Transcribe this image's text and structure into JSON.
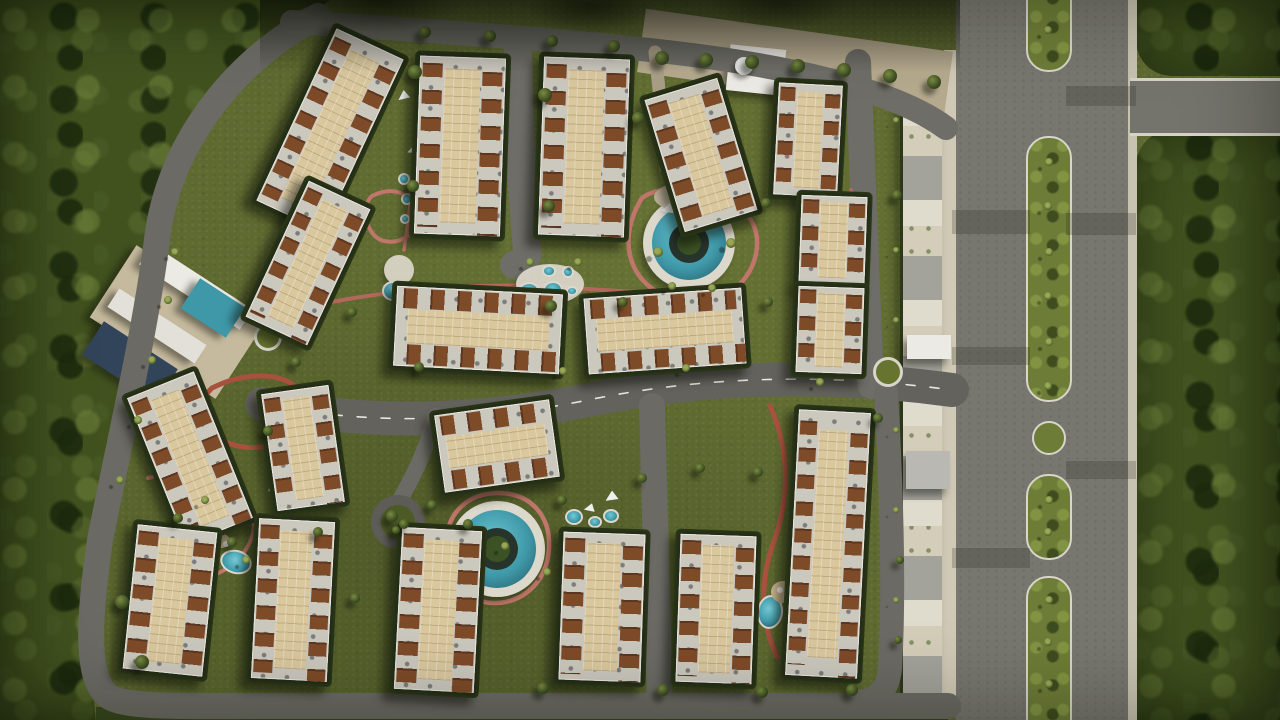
{
  "meta": {
    "title": "Aerial top-view 3D master-plan render of a gated residential compound with apartment blocks, pools, landscaped paths, a perimeter road and a tree-lined boulevard",
    "width": 1280,
    "height": 720
  },
  "palette": {
    "grass": "#5e6a30",
    "forest": "#42521f",
    "hedge": "#232c15",
    "asphalt": "#6b6a64",
    "asphalt2": "#6e6d67",
    "boulevard": "#77766f",
    "curb": "#d8d5ca",
    "roofslab": "#cbc8be",
    "court": "#d9c79e",
    "brown": "#7e4b29",
    "teal": "#3f98a8",
    "tealdeep": "#235663",
    "pink": "#c0766a",
    "redtrack": "#a8513e",
    "plaza": "#b5a98e",
    "deck": "#c6ba9e",
    "white": "#eceae4",
    "white2": "#e2e0d8",
    "gray": "#d8d7d0",
    "gray2": "#b9b8b2",
    "solar": "#31445a",
    "sand": "#c9b58f",
    "decklight": "#ddd8cc"
  },
  "scene": {
    "roads": [
      {
        "n": "perimeter-road",
        "d": "M 318,16 C 238,58 172,138 158,232 C 146,328 124,420 100,540 C 88,622 86,678 108,696 C 126,708 180,706 260,706 L 948,706",
        "w": 26,
        "c": "#6b6a64"
      },
      {
        "n": "top-road",
        "d": "M 292,22 C 420,30 540,38 650,50 C 780,64 892,88 946,128",
        "w": 24,
        "c": "#6e6d67"
      },
      {
        "n": "central-road",
        "d": "M 262,404 C 372,426 480,422 588,400 C 700,377 820,372 952,390",
        "w": 34,
        "c": "#63625c"
      },
      {
        "n": "central-road-dashes",
        "d": "M 262,404 C 372,426 480,422 588,400 C 700,377 820,372 952,390",
        "w": 1.6,
        "c": "#e8e6de",
        "dash": "9 15"
      },
      {
        "n": "road-v1",
        "d": "M 518,48 C 520,140 522,204 527,250 C 529,259 524,263 514,265",
        "w": 28,
        "c": "#6e6d67"
      },
      {
        "n": "road-v2",
        "d": "M 858,62 L 871,386",
        "w": 26,
        "c": "#6e6d67"
      },
      {
        "n": "road-v3",
        "d": "M 652,406 L 660,704",
        "w": 26,
        "c": "#6b6a64"
      },
      {
        "n": "road-v4",
        "d": "M 886,392 C 892,500 894,600 890,668 C 888,690 878,700 858,702",
        "w": 24,
        "c": "#6b6a64"
      },
      {
        "n": "road-spur",
        "d": "M 436,416 C 424,456 412,478 401,498",
        "w": 16,
        "c": "#6b6a64"
      },
      {
        "n": "entry-walk",
        "d": "M 655,52 C 660,95 663,132 666,168",
        "w": 13,
        "c": "#a99f87"
      }
    ],
    "tracks": [
      {
        "n": "track-pool-loop",
        "d": "M 642,198 C 618,236 626,280 666,296 C 708,312 748,292 756,254 C 762,222 742,202 710,194 C 684,188 658,186 642,198 Z",
        "w": 4.5,
        "c": "#c0766a"
      },
      {
        "n": "track-mid",
        "d": "M 285,312 C 380,289 480,281 575,288 C 638,293 655,291 666,297",
        "w": 4,
        "c": "#b4685c"
      },
      {
        "n": "track-west-loop",
        "d": "M 212,388 C 248,370 288,372 302,394 C 314,414 302,436 272,445 C 240,453 212,441 205,420 C 201,405 203,396 212,388 Z",
        "w": 5,
        "c": "#a8513e"
      },
      {
        "n": "track-south-ring",
        "d": "M 447,541 C 447,512 469,493 498,493 C 531,493 551,516 549,549 C 547,581 524,603 494,603 C 465,603 447,577 447,541 Z",
        "w": 4.5,
        "c": "#c0766a"
      },
      {
        "n": "track-east",
        "d": "M 770,406 C 791,452 789,502 773,544 C 759,584 761,622 777,657",
        "w": 5,
        "c": "#a8513e"
      },
      {
        "n": "track-sw",
        "d": "M 148,478 C 200,466 243,478 252,510 C 260,540 240,567 208,577",
        "w": 4,
        "c": "#c0766a"
      },
      {
        "n": "track-nw-loop",
        "d": "M 372,196 C 392,186 411,192 415,211 C 419,231 404,245 384,241 C 366,237 360,206 372,196 Z",
        "w": 4,
        "c": "#c0766a"
      },
      {
        "n": "track-ne",
        "d": "M 851,190 C 866,230 866,270 854,308",
        "w": 4,
        "c": "#b4685c"
      },
      {
        "n": "track-nw",
        "d": "M 420,80 C 416,140 412,200 404,250",
        "w": 3.5,
        "c": "#c0766a"
      }
    ],
    "buildings": [
      [
        330,
        130,
        74,
        190,
        25
      ],
      [
        308,
        263,
        68,
        150,
        25
      ],
      [
        460,
        146,
        86,
        178,
        2
      ],
      [
        584,
        147,
        86,
        178,
        2
      ],
      [
        701,
        155,
        76,
        138,
        -17
      ],
      [
        808,
        140,
        64,
        112,
        3
      ],
      [
        833,
        240,
        66,
        88,
        2
      ],
      [
        830,
        330,
        66,
        86,
        2
      ],
      [
        478,
        330,
        166,
        80,
        3
      ],
      [
        665,
        331,
        158,
        76,
        -4
      ],
      [
        190,
        458,
        72,
        158,
        -22
      ],
      [
        303,
        448,
        68,
        118,
        -8
      ],
      [
        497,
        446,
        116,
        78,
        -8
      ],
      [
        170,
        600,
        80,
        145,
        6
      ],
      [
        293,
        600,
        76,
        160,
        3
      ],
      [
        438,
        610,
        80,
        162,
        3
      ],
      [
        602,
        607,
        82,
        148,
        2
      ],
      [
        716,
        609,
        76,
        148,
        2
      ],
      [
        828,
        544,
        72,
        266,
        3
      ]
    ],
    "structures": [
      [
        "entry-plaza",
        795,
        62,
        310,
        64,
        8,
        "plaza"
      ],
      [
        "club-deck",
        176,
        322,
        150,
        86,
        33,
        "deck"
      ],
      [
        "club-slab-a",
        196,
        287,
        120,
        24,
        33,
        "white"
      ],
      [
        "club-slab-b",
        157,
        326,
        104,
        22,
        33,
        "white2"
      ],
      [
        "club-solar",
        130,
        362,
        88,
        40,
        33,
        "solar"
      ],
      [
        "club-pool",
        213,
        308,
        54,
        36,
        33,
        "teal"
      ],
      [
        "gate-building",
        756,
        70,
        56,
        46,
        6,
        "white"
      ],
      [
        "gate-annex",
        800,
        86,
        32,
        38,
        6,
        "gray"
      ],
      [
        "east-gate-canopy",
        929,
        347,
        44,
        24,
        0,
        "white"
      ],
      [
        "east-gatehouse",
        928,
        470,
        44,
        38,
        0,
        "gray2"
      ]
    ],
    "pools3": [
      [
        689,
        243,
        40
      ],
      [
        497,
        549,
        42
      ]
    ],
    "deckpads": [
      [
        550,
        284,
        34,
        20
      ],
      [
        399,
        270,
        15,
        15
      ]
    ],
    "pools": [
      [
        529,
        292,
        11,
        10,
        0
      ],
      [
        553,
        290,
        10,
        9,
        0
      ],
      [
        549,
        271,
        7,
        6,
        0
      ],
      [
        568,
        272,
        6,
        6,
        0
      ],
      [
        572,
        291,
        6,
        5,
        0
      ],
      [
        574,
        517,
        9,
        8,
        0
      ],
      [
        595,
        522,
        7,
        6,
        0
      ],
      [
        611,
        516,
        8,
        7,
        0
      ],
      [
        214,
        517,
        13,
        11,
        -20
      ],
      [
        236,
        562,
        16,
        12,
        15
      ],
      [
        770,
        612,
        13,
        17,
        8
      ],
      [
        404,
        179,
        6,
        6,
        0
      ],
      [
        407,
        199,
        6,
        6,
        0
      ],
      [
        405,
        219,
        5,
        5,
        0
      ],
      [
        393,
        291,
        11,
        10,
        0
      ]
    ],
    "sands": [
      [
        783,
        592,
        12,
        11
      ],
      [
        222,
        541,
        8,
        7
      ]
    ],
    "circles": [
      {
        "k": "rab",
        "x": 888,
        "y": 372,
        "r": 15
      },
      {
        "k": "rab",
        "x": 268,
        "y": 337,
        "r": 14
      },
      {
        "k": "island",
        "x": 1049,
        "y": 438,
        "r": 17
      },
      {
        "k": "cul",
        "x": 398,
        "y": 522,
        "r": 27
      },
      {
        "k": "dome",
        "x": 744,
        "y": 66,
        "r": 9
      }
    ],
    "playground": {
      "x": 688,
      "y": 197,
      "rx": 34,
      "ry": 15,
      "dots": [
        [
          672,
          192,
          "#c2473c"
        ],
        [
          683,
          203,
          "#2d8b97"
        ],
        [
          699,
          192,
          "#d3a038"
        ],
        [
          711,
          201,
          "#3a6fae"
        ],
        [
          693,
          186,
          "#7a4a97"
        ],
        [
          678,
          196,
          "#e0e0dc"
        ]
      ]
    },
    "sails": [
      [
        712,
        204,
        -10,
        14
      ],
      [
        668,
        209,
        15,
        13
      ],
      [
        612,
        497,
        0,
        13
      ],
      [
        590,
        508,
        20,
        11
      ],
      [
        278,
        481,
        -15,
        26
      ],
      [
        414,
        150,
        10,
        12
      ],
      [
        404,
        96,
        -5,
        12
      ]
    ],
    "patches": [
      [
        991,
        222,
        78,
        24
      ],
      [
        1101,
        224,
        70,
        22
      ],
      [
        991,
        558,
        78,
        20
      ],
      [
        1101,
        96,
        70,
        20
      ],
      [
        991,
        356,
        78,
        18
      ],
      [
        1101,
        470,
        70,
        18
      ]
    ],
    "trees": [
      [
        415,
        72,
        7,
        0
      ],
      [
        413,
        186,
        6,
        0
      ],
      [
        545,
        95,
        7,
        0
      ],
      [
        549,
        206,
        6,
        0
      ],
      [
        551,
        306,
        6,
        0
      ],
      [
        638,
        118,
        6,
        0
      ],
      [
        658,
        252,
        5,
        1
      ],
      [
        731,
        243,
        5,
        1
      ],
      [
        766,
        203,
        5,
        0
      ],
      [
        768,
        302,
        5,
        0
      ],
      [
        623,
        302,
        5,
        0
      ],
      [
        419,
        367,
        5,
        0
      ],
      [
        352,
        312,
        5,
        0
      ],
      [
        296,
        362,
        5,
        0
      ],
      [
        268,
        431,
        5,
        0
      ],
      [
        432,
        505,
        5,
        0
      ],
      [
        468,
        524,
        5,
        0
      ],
      [
        562,
        500,
        5,
        0
      ],
      [
        642,
        478,
        5,
        0
      ],
      [
        700,
        468,
        5,
        0
      ],
      [
        758,
        472,
        5,
        0
      ],
      [
        543,
        688,
        6,
        0
      ],
      [
        663,
        690,
        6,
        0
      ],
      [
        762,
        692,
        6,
        0
      ],
      [
        852,
        690,
        6,
        0
      ],
      [
        318,
        532,
        5,
        0
      ],
      [
        232,
        542,
        5,
        0
      ],
      [
        178,
        518,
        5,
        0
      ],
      [
        122,
        602,
        7,
        0
      ],
      [
        142,
        662,
        7,
        0
      ],
      [
        878,
        418,
        5,
        0
      ],
      [
        897,
        195,
        5,
        0
      ],
      [
        563,
        371,
        4,
        1
      ],
      [
        686,
        368,
        4,
        1
      ],
      [
        820,
        382,
        4,
        1
      ],
      [
        355,
        598,
        5,
        0
      ],
      [
        900,
        560,
        4,
        0
      ],
      [
        898,
        640,
        4,
        0
      ],
      [
        662,
        58,
        7,
        0
      ],
      [
        706,
        60,
        7,
        0
      ],
      [
        752,
        62,
        7,
        0
      ],
      [
        798,
        66,
        7,
        0
      ],
      [
        844,
        70,
        7,
        0
      ],
      [
        890,
        76,
        7,
        0
      ],
      [
        934,
        82,
        7,
        0
      ],
      [
        425,
        32,
        6,
        0
      ],
      [
        490,
        36,
        6,
        0
      ],
      [
        552,
        41,
        6,
        0
      ],
      [
        614,
        46,
        6,
        0
      ],
      [
        392,
        516,
        6,
        0
      ],
      [
        404,
        524,
        5,
        0
      ],
      [
        396,
        530,
        4,
        0
      ],
      [
        1049,
        162,
        4,
        1
      ],
      [
        1048,
        206,
        4,
        1
      ],
      [
        1049,
        252,
        4,
        1
      ],
      [
        1048,
        296,
        4,
        1
      ],
      [
        1049,
        342,
        4,
        1
      ],
      [
        1048,
        386,
        4,
        1
      ],
      [
        1049,
        500,
        4,
        1
      ],
      [
        1048,
        532,
        4,
        1
      ],
      [
        1049,
        600,
        4,
        1
      ],
      [
        1048,
        642,
        4,
        1
      ],
      [
        1049,
        684,
        4,
        1
      ],
      [
        1048,
        30,
        4,
        1
      ],
      [
        672,
        286,
        4,
        1
      ],
      [
        712,
        288,
        4,
        1
      ],
      [
        530,
        262,
        4,
        1
      ],
      [
        578,
        262,
        4,
        1
      ],
      [
        505,
        546,
        4,
        1
      ],
      [
        547,
        572,
        4,
        1
      ],
      [
        205,
        500,
        4,
        1
      ],
      [
        246,
        560,
        4,
        1
      ],
      [
        168,
        300,
        4,
        1
      ],
      [
        152,
        360,
        4,
        1
      ],
      [
        138,
        420,
        4,
        1
      ],
      [
        120,
        480,
        4,
        1
      ],
      [
        175,
        252,
        4,
        1
      ],
      [
        896,
        120,
        3,
        1
      ],
      [
        896,
        250,
        3,
        1
      ],
      [
        896,
        320,
        3,
        1
      ],
      [
        896,
        430,
        3,
        1
      ],
      [
        896,
        510,
        3,
        1
      ],
      [
        896,
        600,
        3,
        1
      ]
    ]
  }
}
